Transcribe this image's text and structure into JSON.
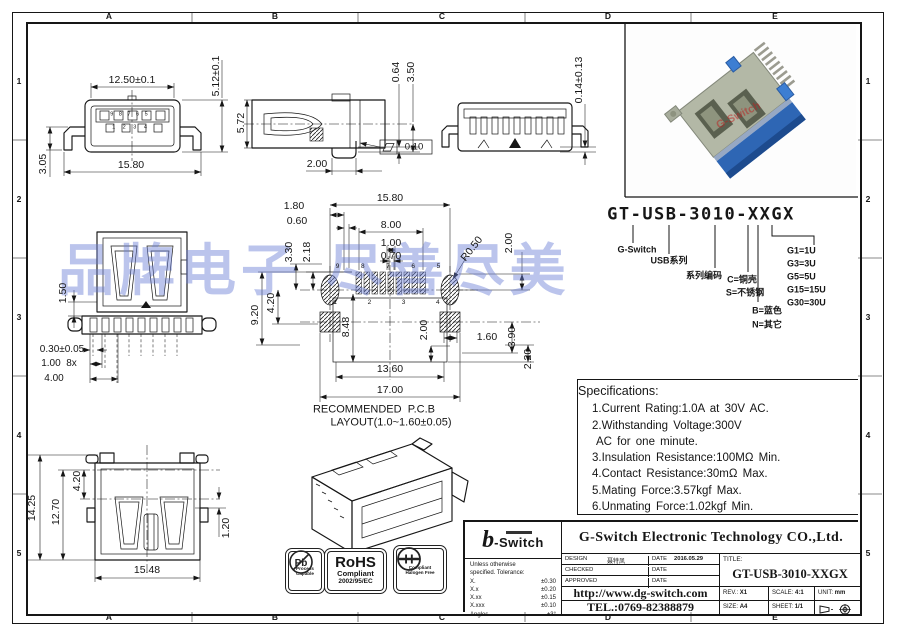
{
  "zones": {
    "cols": [
      "A",
      "B",
      "C",
      "D",
      "E"
    ],
    "rows": [
      "1",
      "2",
      "3",
      "4",
      "5"
    ]
  },
  "watermark": "品牌电子 尽善尽美",
  "colors": {
    "watermark_blue": "#697dd4",
    "photo_shell_blue": "#2e66b4",
    "photo_clip_blue": "#3d7ed2",
    "line": "#161616"
  },
  "dim_labels": {
    "f_top": "12.50±0.1",
    "f_h": "5.12±0.1",
    "f_leg": "3.05",
    "f_bw": "15.80",
    "f_p9": "9 8 7 6 5",
    "f_p1": "1 2 3 4",
    "s_h": "5.72",
    "s_foot": "2.00",
    "s_064": "0.64",
    "s_350": "3.50",
    "s_flat": "0.10",
    "r_cop": "0.14±0.13",
    "t_150": "1.50",
    "t_pin": "0.30±0.05",
    "t_pitch": "1.00  8x",
    "t_400": "4.00",
    "p_1580": "15.80",
    "p_180": "1.80",
    "p_060": "0.60",
    "p_800": "8.00",
    "p_100": "1.00",
    "p_070": "0.70",
    "p_330": "3.30",
    "p_218": "2.18",
    "p_r050": "R0.50",
    "p_200a": "2.00",
    "p_920": "9.20",
    "p_420": "4.20",
    "p_848": "8.48",
    "p_200b": "2.00",
    "p_1360": "13.60",
    "p_160": "1.60",
    "p_390": "3.90",
    "p_220": "2.20",
    "p_1700": "17.00",
    "p_p9": "9  8  7  6  5",
    "p_p1": "1  2  3  4",
    "p_cap1": "RECOMMENDED  P.C.B",
    "p_cap2": "LAYOUT(1.0~1.60±0.05)",
    "b_1425": "14.25",
    "b_1270": "12.70",
    "b_420": "4.20",
    "b_120": "1.20",
    "b_1548": "15.48"
  },
  "part_number": {
    "code": "GT-USB-3010-XXGX",
    "g_switch": "G-Switch",
    "usb": "USB系列",
    "series": "系列编码",
    "c": "C=铜壳",
    "s": "S=不锈钢",
    "b": "B=蓝色",
    "n": "N=其它",
    "g1": "G1=1U",
    "g3": "G3=3U",
    "g5": "G5=5U",
    "g15": "G15=15U",
    "g30": "G30=30U"
  },
  "photo": {
    "watermark": "G-Switch"
  },
  "specifications": {
    "title": "Specifications:",
    "items": [
      "1.Current Rating:1.0A at 30V AC.",
      "2.Withstanding Voltage:300V",
      "AC for one minute.",
      "3.Insulation Resistance:100MΩ Min.",
      "4.Contact Resistance:30mΩ Max.",
      "5.Mating Force:3.57kgf Max.",
      "6.Unmating Force:1.02kgf Min."
    ]
  },
  "title_block": {
    "company": "G-Switch Electronic Technology CO.,Ltd.",
    "logo_prefix": "b",
    "logo_name": "-Switch",
    "tol_l1": "Unless otherwise",
    "tol_l2": "specified. Tolerance:",
    "tol_rows": [
      [
        "X.",
        "±0.30"
      ],
      [
        "X.x",
        "±0.20"
      ],
      [
        "X.xx",
        "±0.15"
      ],
      [
        "X.xxx",
        "±0.10"
      ],
      [
        "Angles",
        "±3°"
      ]
    ],
    "design_label": "DESIGN",
    "design_name": "聂特凤",
    "date_label": "DATE",
    "design_date": "2016.05.29",
    "checked_label": "CHECKED",
    "approved_label": "APPROVED",
    "url": "http://www.dg-switch.com",
    "tel": "TEL.:0769-82388879",
    "title_label": "TITLE:",
    "title_value": "GT-USB-3010-XXGX",
    "rev_label": "REV.:",
    "rev": "X1",
    "scale_label": "SCALE:",
    "scale": "4:1",
    "unit_label": "UNIT:",
    "unit": "mm",
    "size_label": "SIZE:",
    "size": "A4",
    "sheet_label": "SHEET:",
    "sheet": "1/1"
  },
  "logos": {
    "pb": "Pb",
    "pb_cap1": "Process",
    "pb_cap2": "Capable",
    "rohs": "RoHS",
    "rohs_l1": "Compliant",
    "rohs_l2": "2002/95/EC",
    "h": "H",
    "h_l1": "Compliant",
    "h_l2": "Halogen Free"
  },
  "pcb_caption": "RECOMMENDED P.C.B LAYOUT(1.0~1.60±0.05)"
}
